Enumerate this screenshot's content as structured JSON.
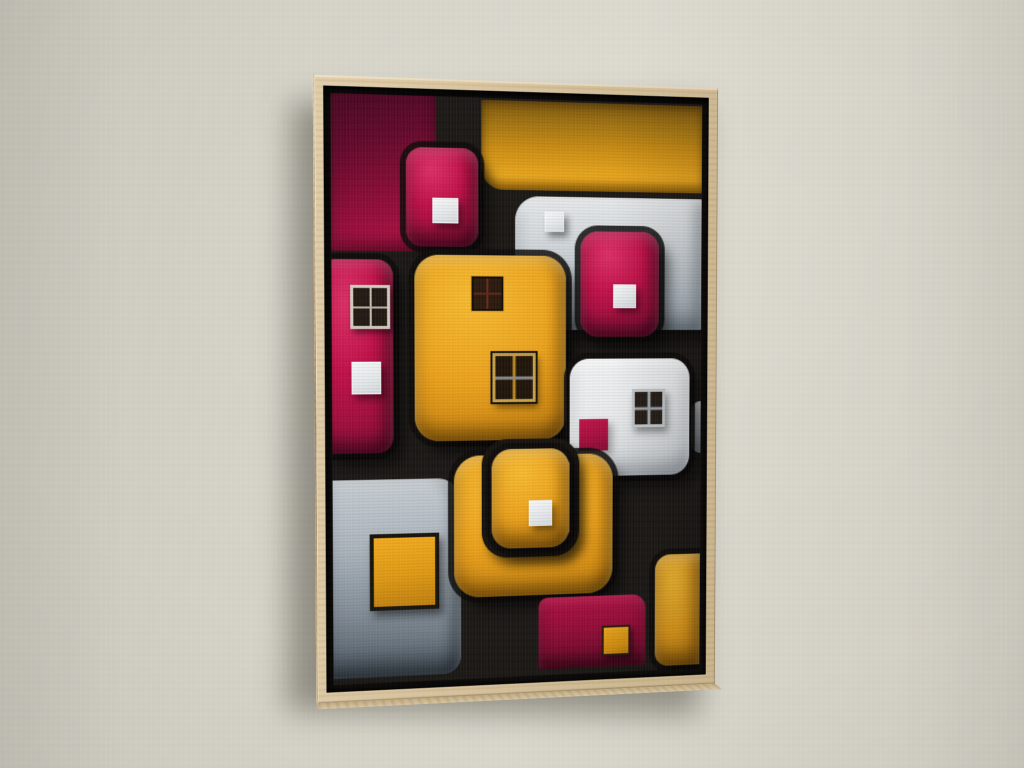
{
  "scene": {
    "description": "Photograph of a framed abstract geometric painting hanging on a plain wall, viewed at a slight left angle",
    "wall_color": "#d4d1c6",
    "wall_shadow_color": "#3c3931",
    "frame": {
      "style": "natural wood float frame",
      "wood_color": "#d5c099",
      "wood_side_color": "#b0placeholder",
      "float_gap_color": "#0f0d0b"
    }
  },
  "artwork": {
    "style": "abstract rounded blocks with small square and window accents on black",
    "palette": {
      "background_black": "#1b1815",
      "crimson": "#a50f40",
      "magenta": "#c21149",
      "amber": "#eda31c",
      "silver": "#b5bdc4",
      "white": "#e9ebec"
    },
    "canvas": {
      "width": 376,
      "height": 578
    },
    "blocks": [
      {
        "name": "crimson-panel-top-left",
        "color": "crimson-flat",
        "rect": [
          0,
          0,
          103,
          152
        ],
        "radius": "2px"
      },
      {
        "name": "amber-panel-top-right",
        "color": "amber-deep",
        "rect": [
          148,
          2,
          230,
          88
        ],
        "radius": "2px 0 0 22px"
      },
      {
        "name": "silver-panel-top",
        "color": "silver",
        "rect": [
          182,
          96,
          196,
          133
        ],
        "radius": "24px 4px 4px 18px",
        "accents": [
          {
            "type": "square-white",
            "name": "white-square",
            "rect": [
              30,
              15,
              20,
              20
            ]
          }
        ]
      },
      {
        "name": "silver-sliver-right-edge",
        "color": "silver",
        "rect": [
          366,
          302,
          14,
          53
        ],
        "radius": "10px 0 0 10px"
      },
      {
        "name": "amber-panel-bottom-right",
        "color": "amber-candy",
        "rect": [
          328,
          459,
          50,
          115
        ],
        "radius": "16px 0 0 14px"
      },
      {
        "name": "magenta-panel-left",
        "color": "magenta-candy",
        "rect": [
          -12,
          160,
          72,
          190
        ],
        "radius": "16px",
        "accents": [
          {
            "type": "window-light",
            "name": "window",
            "rect": [
              30,
              25,
              33,
              37
            ]
          },
          {
            "type": "square-white",
            "name": "white-square",
            "rect": [
              31,
              100,
              29,
              32
            ]
          }
        ]
      },
      {
        "name": "silver-panel-bottom-left",
        "color": "silver-dark",
        "rect": [
          -10,
          376,
          137,
          196
        ],
        "radius": "0 24px 18px 0",
        "accents": [
          {
            "type": "square-amber-bordered",
            "name": "amber-square",
            "rect": [
              46,
              54,
              61,
              68
            ]
          }
        ]
      },
      {
        "name": "magenta-block-top",
        "color": "magenta-candy",
        "rect": [
          73,
          50,
          72,
          97
        ],
        "radius": "16px",
        "accents": [
          {
            "type": "square-white",
            "name": "white-square",
            "rect": [
              26,
              49,
              26,
              25
            ]
          }
        ]
      },
      {
        "name": "magenta-block-right",
        "color": "magenta-candy",
        "rect": [
          249,
          130,
          82,
          106
        ],
        "radius": "18px",
        "accents": [
          {
            "type": "square-white",
            "name": "white-square",
            "rect": [
              34,
              53,
              24,
              24
            ]
          }
        ]
      },
      {
        "name": "amber-house-center",
        "color": "amber-candy",
        "rect": [
          81,
          155,
          153,
          184
        ],
        "radius": "24px",
        "accents": [
          {
            "type": "window-amber-small",
            "name": "small-window",
            "rect": [
              57,
              21,
              28,
              30
            ]
          },
          {
            "type": "window-amber-large",
            "name": "large-window",
            "rect": [
              78,
              97,
              38,
              43
            ]
          }
        ]
      },
      {
        "name": "white-block-right",
        "color": "white-block",
        "rect": [
          238,
          258,
          126,
          119
        ],
        "radius": "20px",
        "accents": [
          {
            "type": "window-gray",
            "name": "window",
            "rect": [
              65,
              31,
              29,
              33
            ]
          },
          {
            "type": "square-crimson",
            "name": "crimson-square",
            "rect": [
              10,
              61,
              30,
              32
            ]
          }
        ]
      },
      {
        "name": "amber-block-bottom",
        "color": "amber-candy",
        "rect": [
          120,
          354,
          163,
          142
        ],
        "radius": "26px"
      },
      {
        "name": "nested-block-outline",
        "color": "outline",
        "rect": [
          148,
          338,
          100,
          119
        ],
        "radius": "26px"
      },
      {
        "name": "amber-nested-block",
        "color": "amber-candy",
        "rect": [
          158,
          348,
          80,
          100
        ],
        "radius": "20px",
        "accents": [
          {
            "type": "square-white",
            "name": "white-square",
            "rect": [
              38,
              52,
              24,
              26
            ]
          }
        ]
      },
      {
        "name": "magenta-panel-bottom",
        "color": "magenta-deep",
        "rect": [
          206,
          499,
          112,
          73
        ],
        "radius": "10px 14px 4px 4px",
        "accents": [
          {
            "type": "square-amber",
            "name": "amber-square",
            "rect": [
              66,
              31,
              26,
              27
            ]
          }
        ]
      }
    ]
  }
}
